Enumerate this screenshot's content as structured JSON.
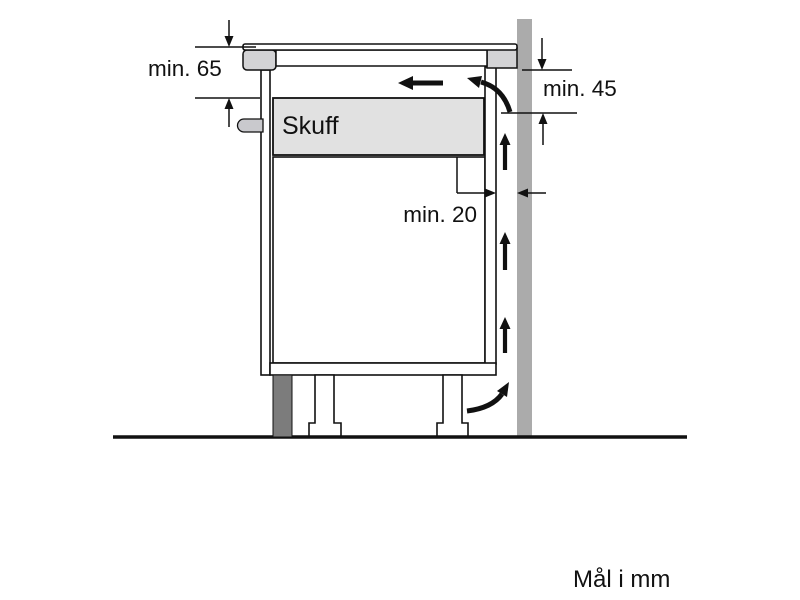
{
  "diagram": {
    "labels": {
      "clearance_top": "min. 65",
      "clearance_back": "min. 45",
      "wall_gap": "min. 20"
    },
    "drawer_label": "Skuff",
    "units_note": "Mål i mm",
    "colors": {
      "line": "#111111",
      "wall": "#ababab",
      "countertop": "#d3d3d5",
      "cooktop_body": "#ffffff",
      "drawer": "#e1e1e1",
      "plinth": "#7c7c7c",
      "connection_pin": "#c9c9cd",
      "background": "#ffffff"
    }
  }
}
